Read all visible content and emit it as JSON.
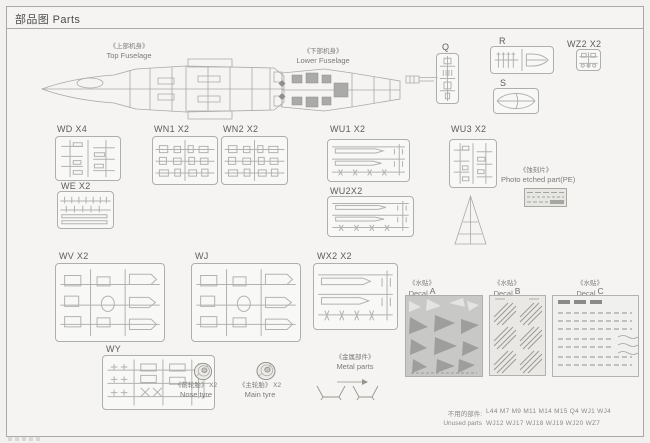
{
  "header": {
    "title": "部品图 Parts"
  },
  "fuselages": {
    "top": {
      "zh": "《上部机身》",
      "en": "Top Fuselage"
    },
    "lower": {
      "zh": "《下部机身》",
      "en": "Lower Fuselage"
    }
  },
  "sprues": {
    "q": {
      "label": "Q"
    },
    "r": {
      "label": "R"
    },
    "s": {
      "label": "S"
    },
    "wz2": {
      "label": "WZ2 X2"
    },
    "wd": {
      "label": "WD X4"
    },
    "wn1": {
      "label": "WN1 X2"
    },
    "wn2": {
      "label": "WN2 X2"
    },
    "wu1": {
      "label": "WU1 X2"
    },
    "wu3": {
      "label": "WU3 X2"
    },
    "we": {
      "label": "WE X2"
    },
    "wu2": {
      "label": "WU2X2"
    },
    "wv": {
      "label": "WV X2"
    },
    "wj": {
      "label": "WJ"
    },
    "wx2": {
      "label": "WX2 X2"
    },
    "wy": {
      "label": "WY"
    }
  },
  "photo_etched": {
    "zh": "《蚀刻片》",
    "en": "Photo etched part(PE)"
  },
  "decals": {
    "zh": "《水贴》",
    "word": "Decal",
    "letters": {
      "a": "A",
      "b": "B",
      "c": "C"
    }
  },
  "tyres": {
    "nose": {
      "zh": "《前轮胎》",
      "qty": "X2",
      "en": "Nose tyre"
    },
    "main": {
      "zh": "《主轮胎》",
      "qty": "X2",
      "en": "Main tyre"
    }
  },
  "metal": {
    "zh": "《金属部件》",
    "en": "Metal parts"
  },
  "unused": {
    "zh": "不用的部件:",
    "en": "Unused parts",
    "line1": "L44 M7 M9 M11 M14 M15 Q4 WJ1 WJ4",
    "line2": "WJ12 WJ17 WJ18 WJ19 WJ20 WZ7"
  }
}
